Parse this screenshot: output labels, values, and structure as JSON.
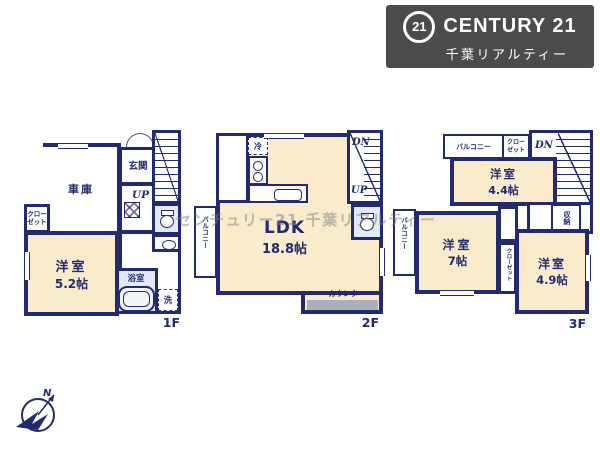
{
  "logo": {
    "number": "21",
    "name": "CENTURY 21",
    "subtitle": "千葉リアルティー"
  },
  "watermark": "センチュリー21 千葉リアルティー",
  "compass": {
    "north": "N"
  },
  "floor1": {
    "label": "1F",
    "garage": "車庫",
    "entrance": "玄関",
    "up": "UP",
    "closet_line1": "クロー",
    "closet_line2": "ゼット",
    "room_name": "洋室",
    "room_size": "5.2帖",
    "bath": "浴室",
    "laundry": "洗"
  },
  "floor2": {
    "label": "2F",
    "fridge": "冷",
    "dn": "DN",
    "up": "UP",
    "balcony": "バルコニー",
    "room_name": "LDK",
    "room_size": "18.8帖",
    "counter": "カウンター"
  },
  "floor3": {
    "label": "3F",
    "balcony_top": "バルコニー",
    "closet_top_line1": "クロー",
    "closet_top_line2": "ゼット",
    "dn": "DN",
    "room1_name": "洋室",
    "room1_size": "4.4帖",
    "balcony_left": "バルコニー",
    "room2_name": "洋室",
    "room2_size": "7帖",
    "closet_mid": "クローゼット",
    "storage": "収納",
    "room3_name": "洋室",
    "room3_size": "4.9帖"
  }
}
